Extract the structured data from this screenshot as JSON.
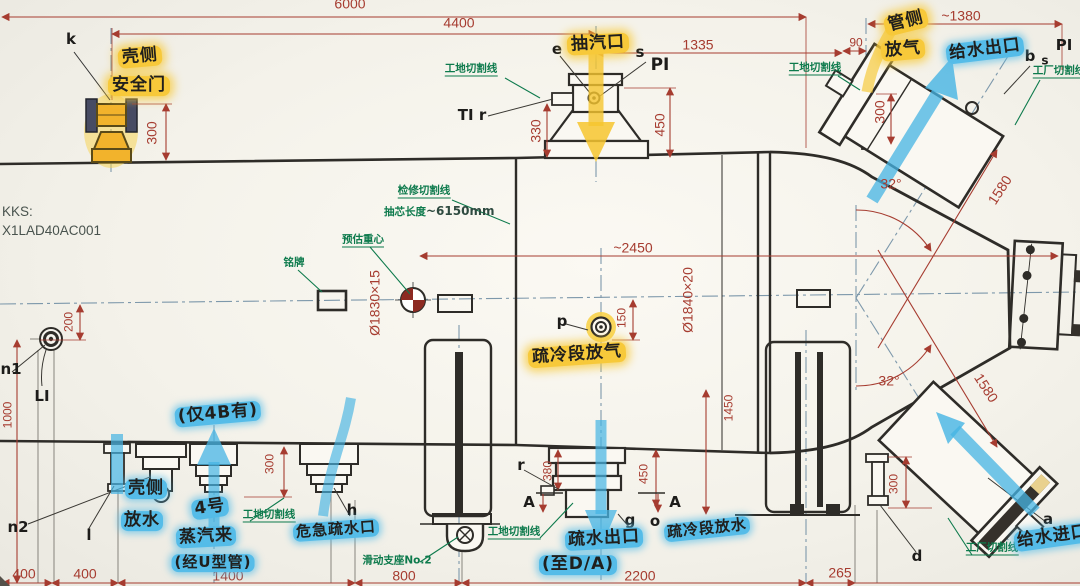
{
  "kks": {
    "label": "KKS:",
    "code": "X1LAD40AC001"
  },
  "dims": {
    "d6000": "6000",
    "d4400": "4400",
    "d1335": "1335",
    "d1380": "~1380",
    "d90": "90",
    "k300": "300",
    "e330": "330",
    "e450": "450",
    "vent300": "300",
    "r1580_top": "1580",
    "r1580_bot": "1580",
    "angle_top": "32°",
    "angle_bot": "32°",
    "d2450": "~2450",
    "od_left": "Ø1830×15",
    "od_right": "Ø1840×20",
    "p150": "150",
    "n200": "200",
    "v1000": "1000",
    "v1450": "1450",
    "r380": "380",
    "r450": "450",
    "h300": "300",
    "d300": "300",
    "b400a": "400",
    "b400b": "400",
    "b1400": "1400",
    "b800": "800",
    "b2200": "2200",
    "b265": "265"
  },
  "ports": {
    "k": "k",
    "e": "e",
    "s_top": "s",
    "pi_top": "PI",
    "ti_r": "TI r",
    "b": "b",
    "s_right": "s",
    "pi_right": "PI",
    "p": "p",
    "n1": "n1",
    "n2": "n2",
    "l": "l",
    "li": "LI",
    "h": "h",
    "r": "r",
    "a_left": "A",
    "a_right": "A",
    "g": "g",
    "o": "o",
    "a": "a",
    "d": "d"
  },
  "green_notes": {
    "site_cut_top": "工地切割线",
    "site_cut_right": "工地切割线",
    "factory_cut_top": "工厂切割线",
    "service_cut": "检修切割线",
    "pull_length_prefix": "抽芯长度",
    "pull_length_value": "~6150mm",
    "cog": "预估重心",
    "nameplate": "铭牌",
    "site_cut_bottom_left": "工地切割线",
    "site_cut_bottom_mid": "工地切割线",
    "factory_cut_bottom": "工厂切割线",
    "support": "滑动支座No.2"
  },
  "hand_notes": {
    "shell_safety_line1": "壳侧",
    "shell_safety_line2": "安全门",
    "extraction_port": "抽汽口",
    "tube_side_line1": "管侧",
    "tube_side_line2": "放气",
    "feedwater_outlet": "给水出口",
    "feedwater_inlet": "给水进口",
    "drain_cooling_vent": "疏冷段放气",
    "only_4b": "(仅4B有)",
    "shell_drain_line1": "壳侧",
    "shell_drain_line2": "放水",
    "no4_line1": "4号",
    "no4_line2": "蒸汽来",
    "no4_line3": "(经U型管)",
    "emergency_drain": "危急疏水口",
    "drain_outlet": "疏水出口",
    "drain_outlet_dest": "(至D/A)",
    "drain_cooling_drain": "疏冷段放水"
  },
  "colors": {
    "ink": "#2e2c28",
    "dimension": "#a63c30",
    "annotation_green": "#0d7a4c",
    "highlight_yellow": "#f7c93a",
    "highlight_blue": "#55bce8",
    "centerline": "#7d98ab"
  }
}
